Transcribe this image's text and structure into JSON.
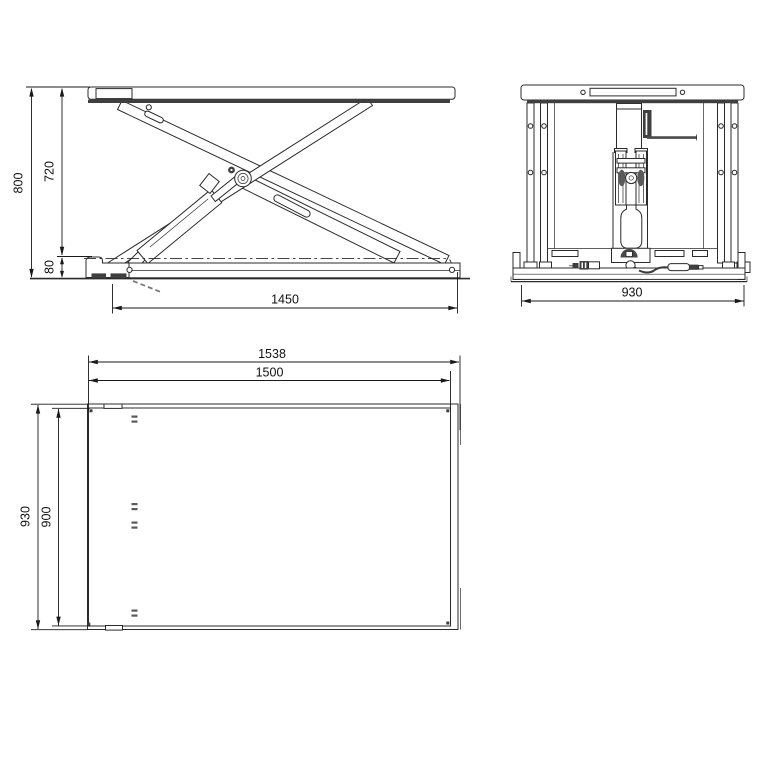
{
  "drawing": {
    "subject": "scissor-lift-table-three-view-technical-drawing",
    "front": {
      "dims": {
        "overall_height": "800",
        "travel_height": "720",
        "lowered_height": "80",
        "base_length": "1450"
      }
    },
    "side": {
      "dims": {
        "overall_width": "930"
      }
    },
    "plan": {
      "dims": {
        "length_overall": "1538",
        "platform_length": "1500",
        "width_overall": "930",
        "platform_width": "900"
      }
    },
    "colors": {
      "background": "#ffffff",
      "line": "#2b2b2b",
      "dark_fill": "#3f3f3f",
      "dimension_text": "#1a1a1a"
    }
  }
}
